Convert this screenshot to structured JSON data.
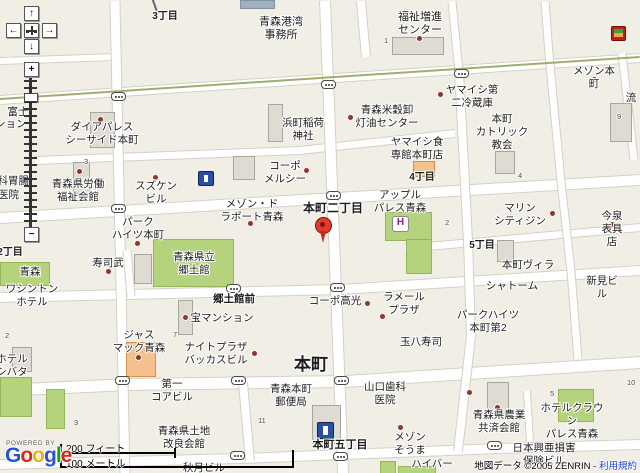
{
  "map": {
    "roads": [
      [
        0,
        60,
        115,
        56,
        6
      ],
      [
        0,
        99,
        640,
        57,
        8
      ],
      [
        35,
        159,
        300,
        149,
        7
      ],
      [
        300,
        149,
        455,
        132,
        7
      ],
      [
        0,
        217,
        640,
        179,
        10
      ],
      [
        405,
        247,
        640,
        226,
        7
      ],
      [
        0,
        296,
        340,
        288,
        9
      ],
      [
        340,
        288,
        640,
        269,
        9
      ],
      [
        0,
        389,
        130,
        383,
        11
      ],
      [
        130,
        383,
        345,
        380,
        11
      ],
      [
        345,
        380,
        640,
        361,
        11
      ],
      [
        0,
        463,
        240,
        457,
        9
      ],
      [
        240,
        457,
        500,
        447,
        9
      ],
      [
        500,
        447,
        640,
        443,
        9
      ],
      [
        115,
        0,
        125,
        473,
        9
      ],
      [
        325,
        0,
        343,
        473,
        10
      ],
      [
        361,
        0,
        366,
        56,
        8
      ],
      [
        452,
        0,
        459,
        70,
        7
      ],
      [
        459,
        70,
        468,
        240,
        8
      ],
      [
        468,
        240,
        471,
        335,
        8
      ],
      [
        471,
        335,
        458,
        450,
        8
      ],
      [
        545,
        0,
        549,
        53,
        7
      ],
      [
        549,
        53,
        561,
        180,
        7
      ],
      [
        561,
        180,
        571,
        270,
        7
      ],
      [
        571,
        270,
        578,
        358,
        7
      ],
      [
        622,
        52,
        634,
        158,
        7
      ],
      [
        127,
        249,
        131,
        295,
        7
      ],
      [
        243,
        382,
        250,
        460,
        8
      ],
      [
        527,
        390,
        530,
        441,
        6
      ]
    ],
    "green_lines": [
      [
        0,
        99,
        640,
        57,
        2
      ]
    ],
    "thin_lines": [
      [
        153,
        0,
        158,
        14,
        1.5
      ]
    ],
    "areas": [
      [
        "g",
        153,
        239,
        79,
        46
      ],
      [
        "g",
        385,
        212,
        45,
        27
      ],
      [
        "g",
        406,
        239,
        24,
        33
      ],
      [
        "g",
        558,
        389,
        34,
        31
      ],
      [
        "g",
        0,
        262,
        48,
        22
      ],
      [
        "g",
        0,
        377,
        30,
        38
      ],
      [
        "g",
        46,
        389,
        17,
        38
      ],
      [
        "g",
        380,
        461,
        14,
        12
      ],
      [
        "g",
        398,
        466,
        36,
        7
      ],
      [
        "b",
        90,
        112,
        23,
        34
      ],
      [
        "b",
        73,
        162,
        15,
        30
      ],
      [
        "b",
        233,
        156,
        20,
        22
      ],
      [
        "b",
        268,
        104,
        13,
        36
      ],
      [
        "b",
        495,
        151,
        18,
        21
      ],
      [
        "b",
        134,
        254,
        16,
        28
      ],
      [
        "b",
        178,
        300,
        13,
        33
      ],
      [
        "b",
        12,
        347,
        18,
        23
      ],
      [
        "b",
        312,
        405,
        27,
        37
      ],
      [
        "b",
        487,
        382,
        20,
        30
      ],
      [
        "b",
        610,
        103,
        20,
        37
      ],
      [
        "b",
        392,
        37,
        50,
        16
      ],
      [
        "b",
        497,
        240,
        15,
        20
      ],
      [
        "o",
        126,
        342,
        28,
        33
      ],
      [
        "o",
        413,
        161,
        20,
        14
      ],
      [
        "s",
        240,
        0,
        33,
        7
      ]
    ],
    "labels": [
      {
        "t": "3丁目",
        "x": 165,
        "y": 11,
        "s": 10,
        "b": true
      },
      {
        "t": "青森港湾\n事務所",
        "x": 281,
        "y": 16,
        "s": 11
      },
      {
        "t": "福祉増進\nセンター",
        "x": 420,
        "y": 11,
        "s": 11
      },
      {
        "t": "メゾン本町",
        "x": 594,
        "y": 65
      },
      {
        "t": "流",
        "x": 631,
        "y": 92
      },
      {
        "t": "富士",
        "x": 18,
        "y": 106
      },
      {
        "t": "マンション",
        "x": -26,
        "y": 118,
        "a": "left"
      },
      {
        "t": "ダイアパレス\nシーサイド本町",
        "x": 102,
        "y": 121
      },
      {
        "t": "青森米穀卸\n灯油センター",
        "x": 387,
        "y": 104
      },
      {
        "t": "ヤマイシ第\n二冷蔵庫",
        "x": 472,
        "y": 84
      },
      {
        "t": "浜町稲荷\n神社",
        "x": 303,
        "y": 117
      },
      {
        "t": "コーポ\nメルシー",
        "x": 285,
        "y": 160
      },
      {
        "t": "ヤマイシ食\n専館本町店",
        "x": 417,
        "y": 136
      },
      {
        "t": "本町\nカトリック\n教会",
        "x": 502,
        "y": 113
      },
      {
        "t": "内科胃腸",
        "x": -13,
        "y": 175,
        "a": "left"
      },
      {
        "t": "医院",
        "x": -2,
        "y": 189,
        "a": "left"
      },
      {
        "t": "青森県労働\n福祉会館",
        "x": 78,
        "y": 178
      },
      {
        "t": "スズケン\nビル",
        "x": 156,
        "y": 180
      },
      {
        "t": "メゾン・ド\nラポート青森",
        "x": 252,
        "y": 198
      },
      {
        "t": "本町二丁目",
        "x": 333,
        "y": 201,
        "s": 12,
        "b": true
      },
      {
        "t": "4丁目",
        "x": 422,
        "y": 172,
        "s": 10,
        "b": true
      },
      {
        "t": "アップル\nパレス青森",
        "x": 400,
        "y": 189
      },
      {
        "t": "マリン\nシティジン",
        "x": 520,
        "y": 202
      },
      {
        "t": "今泉表具店",
        "x": 612,
        "y": 210
      },
      {
        "t": "5丁目",
        "x": 482,
        "y": 240,
        "s": 10,
        "b": true
      },
      {
        "t": "パーク\nハイツ本町",
        "x": 138,
        "y": 216
      },
      {
        "t": "2丁目",
        "x": 10,
        "y": 247,
        "s": 10,
        "b": true
      },
      {
        "t": "青森",
        "x": 30,
        "y": 266
      },
      {
        "t": "ワシントン\nホテル",
        "x": 32,
        "y": 283
      },
      {
        "t": "寿司武",
        "x": 108,
        "y": 257
      },
      {
        "t": "青森県立\n郷土館",
        "x": 194,
        "y": 251
      },
      {
        "t": "本町ヴィラ",
        "x": 528,
        "y": 259
      },
      {
        "t": "新見ビル",
        "x": 602,
        "y": 275
      },
      {
        "t": "シャトーム",
        "x": 512,
        "y": 280
      },
      {
        "t": "郷土館前",
        "x": 234,
        "y": 293,
        "b": true
      },
      {
        "t": "コーポ高光",
        "x": 335,
        "y": 295
      },
      {
        "t": "ラメール\nプラザ",
        "x": 404,
        "y": 291
      },
      {
        "t": "宝マンション",
        "x": 222,
        "y": 312
      },
      {
        "t": "パークハイツ\n本町第2",
        "x": 488,
        "y": 309
      },
      {
        "t": "玉八寿司",
        "x": 421,
        "y": 336
      },
      {
        "t": "ジャス\nマック青森",
        "x": 139,
        "y": 329
      },
      {
        "t": "ナイトプラザ\nバッカスビル",
        "x": 216,
        "y": 341
      },
      {
        "t": "ホテル\nシバタ",
        "x": 12,
        "y": 353
      },
      {
        "t": "本町",
        "x": 311,
        "y": 355,
        "s": 17,
        "b": true
      },
      {
        "t": "第一\nコアビル",
        "x": 172,
        "y": 378
      },
      {
        "t": "山口歯科\n医院",
        "x": 385,
        "y": 381
      },
      {
        "t": "青森本町\n郵便局",
        "x": 291,
        "y": 383
      },
      {
        "t": "メゾン\nそうま",
        "x": 410,
        "y": 431
      },
      {
        "t": "青森県農業\n共済会館",
        "x": 499,
        "y": 409
      },
      {
        "t": "ホテルクラウン\nパレス青森",
        "x": 572,
        "y": 402
      },
      {
        "t": "日本興亜損害\n保険ビル",
        "x": 544,
        "y": 442
      },
      {
        "t": "本町五丁目",
        "x": 340,
        "y": 439,
        "s": 11,
        "b": true
      },
      {
        "t": "青森県土地\n改良会館",
        "x": 184,
        "y": 425
      },
      {
        "t": "秋月ビル",
        "x": 204,
        "y": 462
      },
      {
        "t": "ハイバー",
        "x": 432,
        "y": 458
      }
    ],
    "block_numbers": [
      [
        "1",
        384,
        36
      ],
      [
        "3",
        84,
        157
      ],
      [
        "9",
        617,
        112
      ],
      [
        "4",
        518,
        171
      ],
      [
        "2",
        445,
        218
      ],
      [
        "7",
        173,
        330
      ],
      [
        "2",
        5,
        331
      ],
      [
        "11",
        258,
        416
      ],
      [
        "5",
        550,
        389
      ],
      [
        "10",
        627,
        378
      ],
      [
        "3",
        74,
        418
      ]
    ],
    "poi_dots": [
      [
        100,
        119
      ],
      [
        79,
        171
      ],
      [
        155,
        177
      ],
      [
        306,
        170
      ],
      [
        350,
        117
      ],
      [
        419,
        38
      ],
      [
        440,
        94
      ],
      [
        594,
        79
      ],
      [
        552,
        213
      ],
      [
        612,
        224
      ],
      [
        250,
        223
      ],
      [
        137,
        243
      ],
      [
        185,
        317
      ],
      [
        367,
        303
      ],
      [
        382,
        316
      ],
      [
        254,
        353
      ],
      [
        108,
        271
      ],
      [
        138,
        357
      ],
      [
        469,
        392
      ],
      [
        497,
        407
      ],
      [
        400,
        427
      ]
    ],
    "signals": [
      [
        118,
        96
      ],
      [
        328,
        84
      ],
      [
        461,
        73
      ],
      [
        333,
        195
      ],
      [
        118,
        208
      ],
      [
        233,
        288
      ],
      [
        337,
        287
      ],
      [
        122,
        380
      ],
      [
        238,
        380
      ],
      [
        341,
        380
      ],
      [
        237,
        455
      ],
      [
        340,
        456
      ],
      [
        494,
        445
      ]
    ],
    "icons": {
      "poi_blue": [
        [
          198,
          171,
          14,
          13
        ],
        [
          317,
          422,
          15,
          15
        ]
      ],
      "convenience": [
        611,
        26,
        15,
        15
      ],
      "hotel_h": {
        "x": 392,
        "y": 216,
        "w": 15,
        "h": 14,
        "glyph": "H"
      }
    },
    "marker": {
      "x": 323,
      "y": 243
    }
  },
  "controls": {
    "pan_up": "↑",
    "pan_down": "↓",
    "pan_left": "←",
    "pan_right": "→",
    "zoom_in": "+",
    "zoom_out": "−",
    "slider_ticks": 21
  },
  "scale": {
    "feet_label": "200 フィート",
    "meters_label": "100 メートル"
  },
  "logo": {
    "powered_by": "POWERED BY",
    "letters": [
      [
        "G",
        "#2a53ce"
      ],
      [
        "o",
        "#d6281a"
      ],
      [
        "o",
        "#eeb211"
      ],
      [
        "g",
        "#2a53ce"
      ],
      [
        "l",
        "#12a112"
      ],
      [
        "e",
        "#d6281a"
      ]
    ]
  },
  "copyright": {
    "text": "地図データ ©2005 ZENRIN - ",
    "link": "利用規約"
  }
}
